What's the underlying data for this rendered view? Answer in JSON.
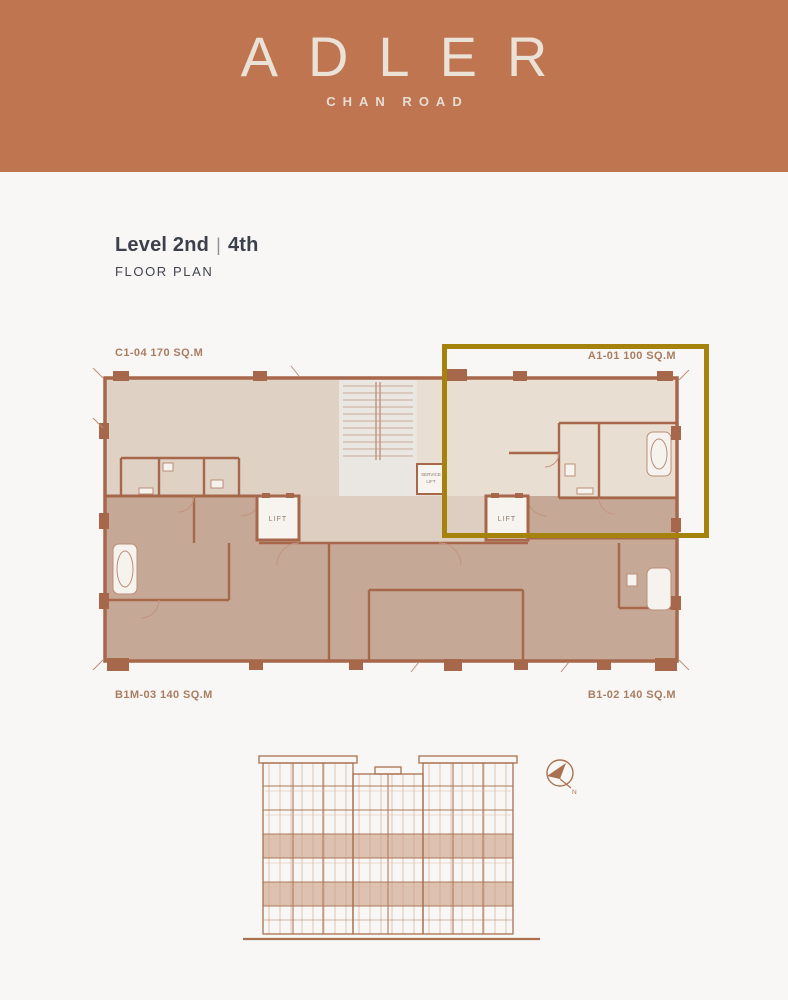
{
  "page": {
    "background": "#F8F7F5"
  },
  "header": {
    "logo": "ADLER",
    "tagline": "CHAN ROAD",
    "background_color": "#BE7550",
    "text_color": "#EAE1D7"
  },
  "title": {
    "level_primary": "Level 2nd",
    "separator": "|",
    "level_secondary": "4th",
    "subtitle": "FLOOR PLAN",
    "text_color": "#3B404B"
  },
  "floor_plan": {
    "units": [
      {
        "label": "C1-04 170 SQ.M",
        "position": "top-left",
        "highlighted": false
      },
      {
        "label": "A1-01 100 SQ.M",
        "position": "top-right",
        "highlighted": true
      },
      {
        "label": "B1M-03 140 SQ.M",
        "position": "bottom-left",
        "highlighted": false
      },
      {
        "label": "B1-02 140 SQ.M",
        "position": "bottom-right",
        "highlighted": false
      }
    ],
    "lift_label": "LIFT",
    "service_lift": [
      "SERVICE",
      "LIFT"
    ],
    "highlight_border_color": "#A5820C",
    "wall_color": "#A7674A",
    "fill_light": "#DFD1C4",
    "fill_highlight_unit": "#E9DED2",
    "fill_dark": "#C6A897",
    "stair_core_fill": "#EAE7E3",
    "label_color": "#A97D62"
  },
  "elevation": {
    "line_color": "#A9714F",
    "highlight_band_color": "#C28E6E"
  },
  "compass": {
    "north_label": "N"
  }
}
